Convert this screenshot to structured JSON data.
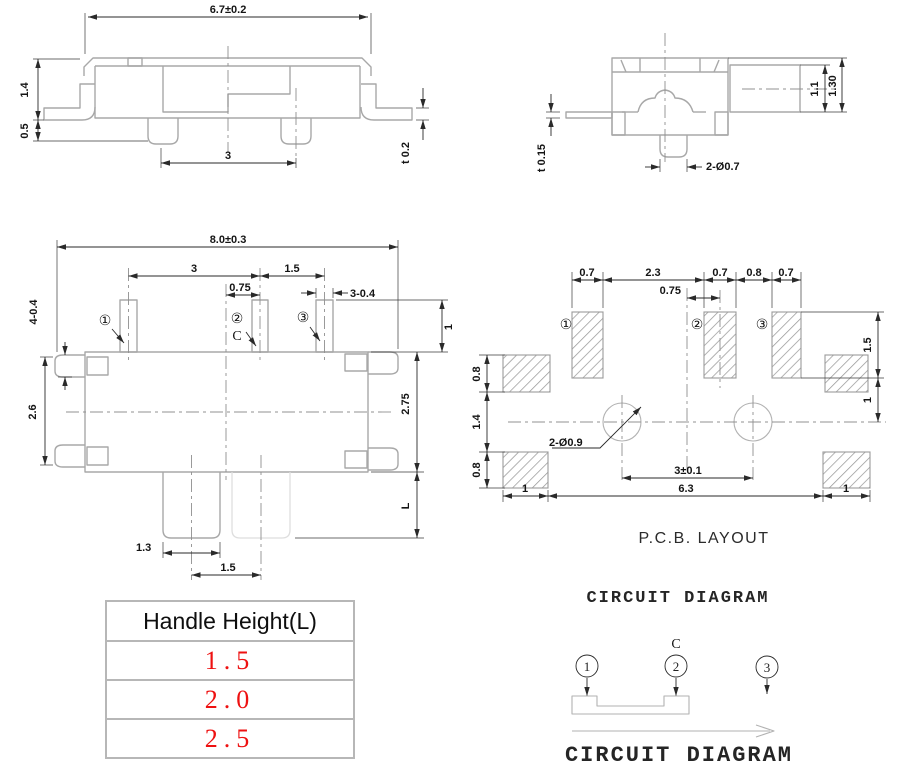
{
  "colors": {
    "outline_gray": "#a8a8a8",
    "dimension_black": "#141414",
    "centerline_gray": "#909090",
    "table_value_red": "#ee1111",
    "hatch_gray": "#999999"
  },
  "side_view": {
    "dim_width": "6.7±0.2",
    "dim_body_height": "1.4",
    "dim_foot_height": "0.5",
    "dim_pin_pitch": "3",
    "dim_thickness": "t 0.2"
  },
  "end_view": {
    "dim_thickness": "t 0.15",
    "dim_pins": "2-Ø0.7",
    "dim_handle_height": "1.1",
    "dim_total_height": "1.30"
  },
  "top_view": {
    "dim_width": "8.0±0.3",
    "dim_pitch_1_2": "3",
    "dim_pitch_2_3": "1.5",
    "dim_offset": "0.75",
    "dim_pin_width": "3-0.4",
    "dim_tabs": "4-0.4",
    "dim_body_left": "2.6",
    "dim_pin_height": "1",
    "dim_body_right": "2.75",
    "dim_handle_length": "L",
    "dim_handle_width": "1.3",
    "dim_travel": "1.5",
    "label_terminal_1": "①",
    "label_terminal_2": "②",
    "label_terminal_3": "③",
    "label_common": "C"
  },
  "pcb_layout": {
    "title": "P.C.B. LAYOUT",
    "dim_pad1_width": "0.7",
    "dim_gap_1_2": "2.3",
    "dim_pad2_width": "0.7",
    "dim_gap_2_3": "0.8",
    "dim_pad3_width": "0.7",
    "dim_offset": "0.75",
    "dim_top_pad_height": "0.8",
    "dim_middle": "1.4",
    "dim_bottom_pad_height": "0.8",
    "dim_pad_height_right": "1.5",
    "dim_right_gap": "1",
    "dim_hole_pitch": "3±0.1",
    "dim_span": "6.3",
    "dim_left_pad_width": "1",
    "dim_right_pad_width": "1",
    "label_holes": "2-Ø0.9",
    "label_pad_1": "①",
    "label_pad_2": "②",
    "label_pad_3": "③"
  },
  "handle_table": {
    "header": "Handle Height(L)",
    "rows": [
      "1.5",
      "2.0",
      "2.5"
    ]
  },
  "circuit_diagram": {
    "title_top": "CIRCUIT DIAGRAM",
    "title_bottom": "CIRCUIT DIAGRAM",
    "label_common": "C",
    "pin1": "1",
    "pin2": "2",
    "pin3": "3"
  }
}
